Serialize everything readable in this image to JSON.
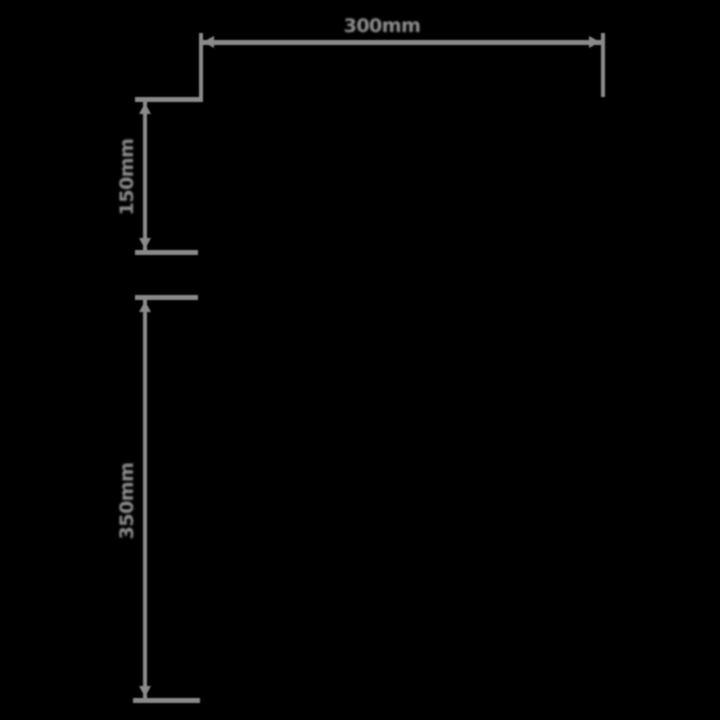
{
  "diagram": {
    "type": "product-dimension-drawing",
    "background_color": "#000000",
    "line_color": "#8a8a8a",
    "text_color": "#8d8d8d",
    "dimensions": [
      {
        "id": "width-top",
        "label": "300mm",
        "orientation": "horizontal"
      },
      {
        "id": "height-upper",
        "label": "150mm",
        "orientation": "vertical"
      },
      {
        "id": "height-lower",
        "label": "350mm",
        "orientation": "vertical"
      }
    ]
  }
}
